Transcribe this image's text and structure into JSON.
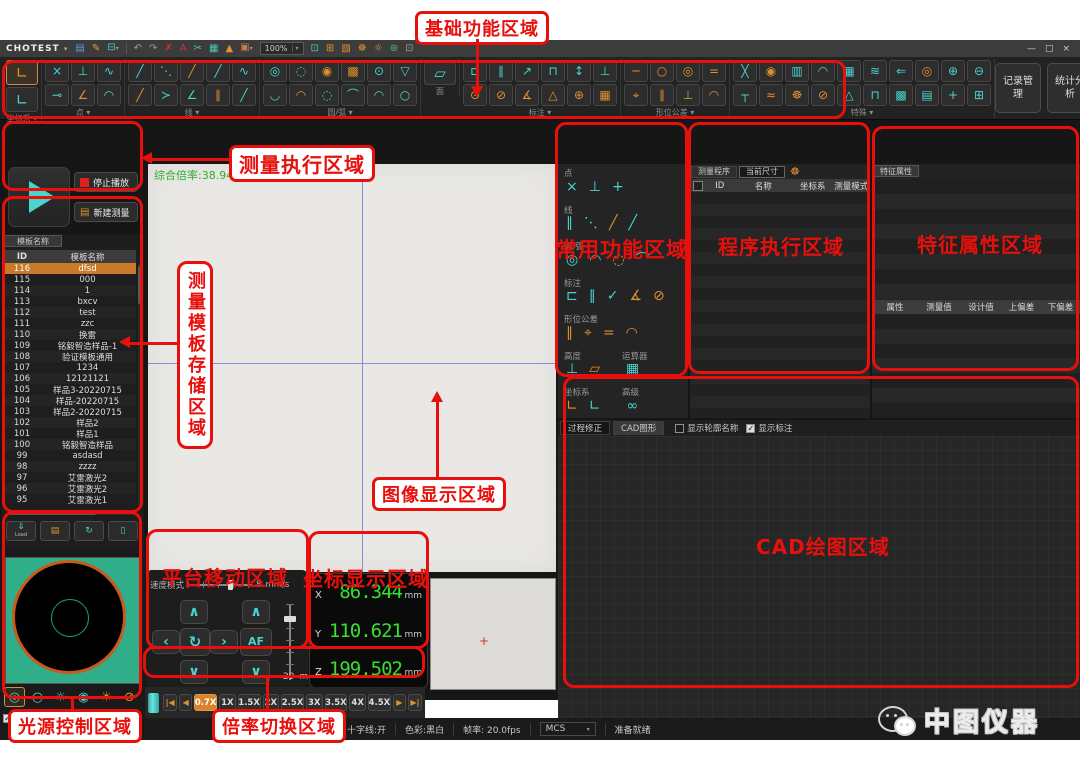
{
  "titlebar": {
    "app_name": "CHOTEST",
    "app_menu_arrow": "▾",
    "zoom_value": "100%",
    "zoom_drop_arrow": "▾",
    "icons": [
      {
        "n": "save-icon",
        "g": "▤",
        "c": "#5b9bd5"
      },
      {
        "n": "edit-icon",
        "g": "✎",
        "c": "#e0a23c"
      },
      {
        "n": "print-icon",
        "g": "⊟",
        "c": "#45c8c0",
        "drop": true
      },
      {
        "n": "divider"
      },
      {
        "n": "undo-icon",
        "g": "↶",
        "c": "#9a9a9a"
      },
      {
        "n": "redo-icon",
        "g": "↷",
        "c": "#9a9a9a"
      },
      {
        "n": "delete-icon",
        "g": "✗",
        "c": "#d63030"
      },
      {
        "n": "font-size-icon",
        "g": "A",
        "c": "#d63030"
      },
      {
        "n": "measure-tool-icon",
        "g": "✂",
        "c": "#45c8c0"
      },
      {
        "n": "table-icon",
        "g": "▦",
        "c": "#45c8c0"
      },
      {
        "n": "mirror-icon",
        "g": "▲",
        "c": "#e0912f"
      },
      {
        "n": "image-icon",
        "g": "▣",
        "c": "#c87a50",
        "drop": true
      }
    ],
    "right_icons": [
      {
        "n": "display-icon",
        "g": "⊡",
        "c": "#45c8c0"
      },
      {
        "n": "snap-icon",
        "g": "⊞",
        "c": "#e0912f"
      },
      {
        "n": "cube-icon",
        "g": "▧",
        "c": "#e0912f"
      },
      {
        "n": "settings-gear-icon",
        "g": "☸",
        "c": "#e0912f"
      },
      {
        "n": "light-bulb-icon",
        "g": "☼",
        "c": "#e0912f"
      },
      {
        "n": "globe-icon",
        "g": "⊛",
        "c": "#52b86a"
      },
      {
        "n": "page-icon",
        "g": "⊡",
        "c": "#9a9a9a"
      }
    ],
    "window_controls": {
      "minimize": "—",
      "maximize": "□",
      "close": "×"
    }
  },
  "ribbon": {
    "drop_arrow": "▾",
    "groups": [
      {
        "label": "坐标系",
        "drop": true,
        "big": true,
        "rows": [
          [
            {
              "g": "∟",
              "t": "o",
              "sel": true
            }
          ],
          [
            {
              "g": "∟",
              "t": "c"
            }
          ]
        ]
      },
      {
        "label": "点",
        "drop": true,
        "rows": [
          [
            {
              "g": "×",
              "t": "c"
            },
            {
              "g": "⊥",
              "t": "c"
            },
            {
              "g": "∿",
              "t": "c"
            }
          ],
          [
            {
              "g": "⊸",
              "t": "c"
            },
            {
              "g": "∠",
              "t": "o"
            },
            {
              "g": "◠",
              "t": "c"
            }
          ]
        ]
      },
      {
        "label": "线",
        "drop": true,
        "rows": [
          [
            {
              "g": "╱",
              "t": "c"
            },
            {
              "g": "⋱",
              "t": "c"
            },
            {
              "g": "╱",
              "t": "o"
            },
            {
              "g": "╱",
              "t": "c"
            },
            {
              "g": "∿",
              "t": "c"
            }
          ],
          [
            {
              "g": "╱",
              "t": "o"
            },
            {
              "g": "≻",
              "t": "c"
            },
            {
              "g": "∠",
              "t": "c"
            },
            {
              "g": "∥",
              "t": "o"
            },
            {
              "g": "╱",
              "t": "c"
            }
          ]
        ]
      },
      {
        "label": "圆/弧",
        "drop": true,
        "rows": [
          [
            {
              "g": "◎",
              "t": "c"
            },
            {
              "g": "◌",
              "t": "c"
            },
            {
              "g": "◉",
              "t": "o"
            },
            {
              "g": "▩",
              "t": "o"
            },
            {
              "g": "⊙",
              "t": "c"
            },
            {
              "g": "▽",
              "t": "c"
            }
          ],
          [
            {
              "g": "◡",
              "t": "c"
            },
            {
              "g": "◠",
              "t": "o"
            },
            {
              "g": "◌",
              "t": "c"
            },
            {
              "g": "⌒",
              "t": "c"
            },
            {
              "g": "◠",
              "t": "c"
            },
            {
              "g": "○",
              "t": "c"
            }
          ]
        ]
      },
      {
        "label": "面",
        "drop": false,
        "big": true,
        "rows": [
          [
            {
              "g": "▱",
              "t": "c"
            }
          ]
        ]
      },
      {
        "label": "标注",
        "drop": true,
        "rows": [
          [
            {
              "g": "⊏",
              "t": "c"
            },
            {
              "g": "∥",
              "t": "c"
            },
            {
              "g": "↗",
              "t": "c"
            },
            {
              "g": "⊓",
              "t": "c"
            },
            {
              "g": "↕",
              "t": "c"
            },
            {
              "g": "⊥",
              "t": "c"
            }
          ],
          [
            {
              "g": "⊙",
              "t": "o"
            },
            {
              "g": "⊘",
              "t": "o"
            },
            {
              "g": "∡",
              "t": "o"
            },
            {
              "g": "△",
              "t": "o"
            },
            {
              "g": "⊕",
              "t": "o"
            },
            {
              "g": "▦",
              "t": "o"
            }
          ]
        ]
      },
      {
        "label": "形位公差",
        "drop": true,
        "rows": [
          [
            {
              "g": "─",
              "t": "o"
            },
            {
              "g": "○",
              "t": "o"
            },
            {
              "g": "◎",
              "t": "o"
            },
            {
              "g": "=",
              "t": "o"
            }
          ],
          [
            {
              "g": "⌖",
              "t": "o"
            },
            {
              "g": "∥",
              "t": "o"
            },
            {
              "g": "⊥",
              "t": "o"
            },
            {
              "g": "◠",
              "t": "o"
            }
          ]
        ]
      },
      {
        "label": "特殊",
        "drop": true,
        "rows": [
          [
            {
              "g": "╳",
              "t": "c"
            },
            {
              "g": "◉",
              "t": "o"
            },
            {
              "g": "▥",
              "t": "c"
            },
            {
              "g": "◠",
              "t": "c"
            },
            {
              "g": "▦",
              "t": "c"
            },
            {
              "g": "≋",
              "t": "c"
            },
            {
              "g": "⇐",
              "t": "c"
            },
            {
              "g": "◎",
              "t": "o"
            },
            {
              "g": "⊕",
              "t": "c"
            },
            {
              "g": "⊖",
              "t": "c"
            }
          ],
          [
            {
              "g": "┬",
              "t": "c"
            },
            {
              "g": "≈",
              "t": "o"
            },
            {
              "g": "☸",
              "t": "o"
            },
            {
              "g": "⊘",
              "t": "o"
            },
            {
              "g": "△",
              "t": "c"
            },
            {
              "g": "⊓",
              "t": "c"
            },
            {
              "g": "▩",
              "t": "c"
            },
            {
              "g": "▤",
              "t": "c"
            },
            {
              "g": "+",
              "t": "c"
            },
            {
              "g": "⊞",
              "t": "c"
            }
          ]
        ]
      }
    ],
    "actions": [
      "记录管理",
      "统计分析"
    ]
  },
  "exec_panel": {
    "stop_label": "停止播放",
    "new_label": "新建测量",
    "doc_icon": "▤"
  },
  "template_panel": {
    "tab": "模板名称",
    "columns": [
      "ID",
      "模板名称"
    ],
    "selected_id": "116",
    "rows": [
      [
        "116",
        "dfsd"
      ],
      [
        "115",
        "000"
      ],
      [
        "114",
        "1"
      ],
      [
        "113",
        "bxcv"
      ],
      [
        "112",
        "test"
      ],
      [
        "111",
        "zzc"
      ],
      [
        "110",
        "换雷"
      ],
      [
        "109",
        "铭毅智造样品-1"
      ],
      [
        "108",
        "验证模板通用"
      ],
      [
        "107",
        "1234"
      ],
      [
        "106",
        "12121121"
      ],
      [
        "105",
        "样品3-20220715"
      ],
      [
        "104",
        "样品-20220715"
      ],
      [
        "103",
        "样品2-20220715"
      ],
      [
        "102",
        "样品2"
      ],
      [
        "101",
        "样品1"
      ],
      [
        "100",
        "铭毅智造样品"
      ],
      [
        "99",
        "asdasd"
      ],
      [
        "98",
        "zzzz"
      ],
      [
        "97",
        "艾雷激光2"
      ],
      [
        "96",
        "艾雷激光2"
      ],
      [
        "95",
        "艾雷激光1"
      ]
    ],
    "actions": [
      {
        "n": "load-template-button",
        "g": "⇓",
        "label": "Load",
        "t": "c"
      },
      {
        "n": "save-template-button",
        "g": "▤",
        "t": "o"
      },
      {
        "n": "refresh-template-button",
        "g": "↻",
        "t": "c"
      },
      {
        "n": "delete-template-button",
        "g": "▯",
        "t": "c"
      }
    ]
  },
  "image_area": {
    "magnification_text": "综合倍率:38.94"
  },
  "common_panel": {
    "sections": [
      {
        "label": "点",
        "icons": [
          {
            "g": "×",
            "t": "c"
          },
          {
            "g": "⊥",
            "t": "c"
          },
          {
            "g": "+",
            "t": "c"
          }
        ]
      },
      {
        "label": "线",
        "icons": [
          {
            "g": "∥",
            "t": "c"
          },
          {
            "g": "⋱",
            "t": "c"
          },
          {
            "g": "╱",
            "t": "o"
          },
          {
            "g": "╱",
            "t": "c"
          }
        ]
      },
      {
        "label": "圆/弧",
        "icons": [
          {
            "g": "◎",
            "t": "c"
          },
          {
            "g": "◠",
            "t": "c"
          },
          {
            "g": "◌",
            "t": "o"
          },
          {
            "g": "⌒",
            "t": "c"
          }
        ]
      },
      {
        "label": "标注",
        "icons": [
          {
            "g": "⊏",
            "t": "c"
          },
          {
            "g": "∥",
            "t": "c"
          },
          {
            "g": "✓",
            "t": "c"
          },
          {
            "g": "∡",
            "t": "o"
          },
          {
            "g": "⊘",
            "t": "o"
          }
        ]
      },
      {
        "label": "形位公差",
        "icons": [
          {
            "g": "∥",
            "t": "o"
          },
          {
            "g": "⌖",
            "t": "o"
          },
          {
            "g": "=",
            "t": "o"
          },
          {
            "g": "◠",
            "t": "o"
          }
        ]
      },
      {
        "label": "高度",
        "label2": "运算器",
        "icons": [
          {
            "g": "⊥",
            "t": "c"
          },
          {
            "g": "▱",
            "t": "o"
          }
        ],
        "icons2": [
          {
            "g": "▦",
            "t": "c"
          }
        ]
      },
      {
        "label": "坐标系",
        "label2": "高级",
        "icons": [
          {
            "g": "∟",
            "t": "o"
          },
          {
            "g": "∟",
            "t": "c"
          }
        ],
        "icons2": [
          {
            "g": "∞",
            "t": "c"
          }
        ]
      }
    ]
  },
  "program_panel": {
    "tabs": [
      "测量程序",
      "当前尺寸"
    ],
    "gear_icon": "☸",
    "columns": [
      "ID",
      "名称",
      "坐标系",
      "测量模式"
    ],
    "empty_rows": 19
  },
  "feature_panel": {
    "tab": "特征属性",
    "columns": [
      "属性",
      "测量值",
      "设计值",
      "上偏差",
      "下偏差"
    ],
    "empty_rows_top": 8,
    "empty_rows_bottom": 7
  },
  "cad_panel": {
    "tabs": [
      "过程修正",
      "CAD图形"
    ],
    "checkboxes": [
      {
        "label": "显示轮廓名称",
        "checked": false
      },
      {
        "label": "显示标注",
        "checked": true
      }
    ],
    "check_glyph": "✓"
  },
  "platform_panel": {
    "speed_label": "速度模式",
    "speed_value": "8",
    "speed_unit": "mm/s",
    "af_label": "AF",
    "z_value": "29",
    "z_unit": "mm/s"
  },
  "coord_panel": {
    "rows": [
      {
        "axis": "X",
        "value": "86.344",
        "unit": "mm"
      },
      {
        "axis": "Y",
        "value": "110.621",
        "unit": "mm"
      },
      {
        "axis": "Z",
        "value": "199.502",
        "unit": "mm"
      }
    ]
  },
  "light_panel": {
    "brightness_label": "亮度",
    "brightness_value": "54",
    "percent_label": "%",
    "icons": [
      {
        "n": "ring-light-icon",
        "g": "◎",
        "t": "c",
        "sel": true
      },
      {
        "n": "outer-ring-light-icon",
        "g": "○",
        "t": "c"
      },
      {
        "n": "segment-ring-light-icon",
        "g": "☼",
        "t": "c"
      },
      {
        "n": "coaxial-light-icon",
        "g": "◉",
        "t": "c"
      },
      {
        "n": "bulb-on-icon",
        "g": "☀",
        "t": "o"
      },
      {
        "n": "bulb-off-icon",
        "g": "⊘",
        "t": "o"
      }
    ]
  },
  "magnification": {
    "first": "|◀",
    "prev": "◀",
    "next": "▶",
    "last": "▶|",
    "options": [
      "0.7X",
      "1X",
      "1.5X",
      "2X",
      "2.5X",
      "3X",
      "3.5X",
      "4X",
      "4.5X"
    ],
    "selected": "0.7X"
  },
  "statusbar": {
    "dot": "●",
    "crosshair": "十字线:开",
    "color_mode": "色彩:黑白",
    "framerate": "帧率: 20.0fps",
    "mcs": "MCS",
    "mcs_arrow": "▾",
    "ready": "准备就绪"
  },
  "watermark": {
    "brand": "中图仪器"
  },
  "annotations": {
    "basic": "基础功能区域",
    "measure_exec": "测量执行区域",
    "template_storage": "测量模板存储区域",
    "image_display": "图像显示区域",
    "common_functions": "常用功能区域",
    "program_exec": "程序执行区域",
    "feature_attrs": "特征属性区域",
    "cad": "CAD绘图区域",
    "platform_move": "平台移动区域",
    "coord_display": "坐标显示区域",
    "light_control": "光源控制区域",
    "mag_switch": "倍率切换区域"
  }
}
